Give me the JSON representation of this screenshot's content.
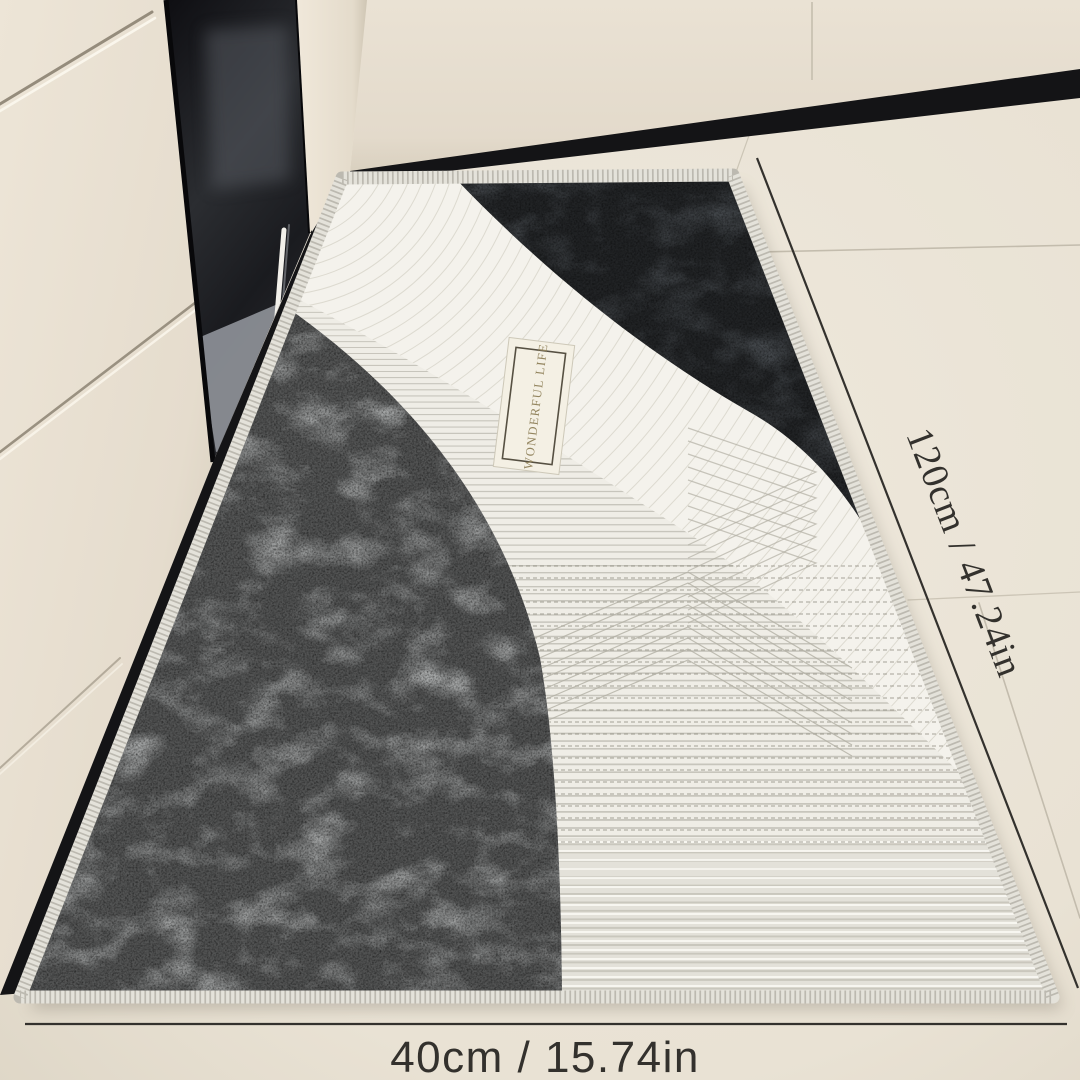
{
  "annotations": {
    "length": "120cm / 47.24in",
    "width": "40cm / 15.74in"
  },
  "mat": {
    "label": "WONDERFUL LIFE"
  },
  "colors": {
    "floor": "#ece6da",
    "floor_edge": "#ded6c6",
    "cabinet": "#e9e1d3",
    "cabinet_dark": "#d6cdbd",
    "side_panel": "#eee6d8",
    "plinth": "#141416",
    "glass_dark": "#101014",
    "glass_mid": "#2b2d31",
    "glass_reflection": "#90939a",
    "handle": "#f2f0ea",
    "mat_base": "#efede6",
    "stripe": "#a8a59a",
    "stripe_dash": "#8b887d",
    "ridge": "#fbfaf5",
    "band": "#f4f2ec",
    "band_line": "#d6d3c8",
    "chevron": "#b2afa4",
    "charcoal": "#43474b",
    "charcoal_light": "#7a7e83",
    "grunge": "#a6a8a8",
    "grunge_dark": "#44464a",
    "serge": "#e4e2da",
    "serge_rib": "#a19e94",
    "label_bg": "#f4f0e4",
    "label_border": "#565042",
    "label_text": "#93855f",
    "dim_line": "#33312d",
    "dim_text": "#33312d",
    "seam": "#c3bcad",
    "shadow": "#5a5246"
  }
}
